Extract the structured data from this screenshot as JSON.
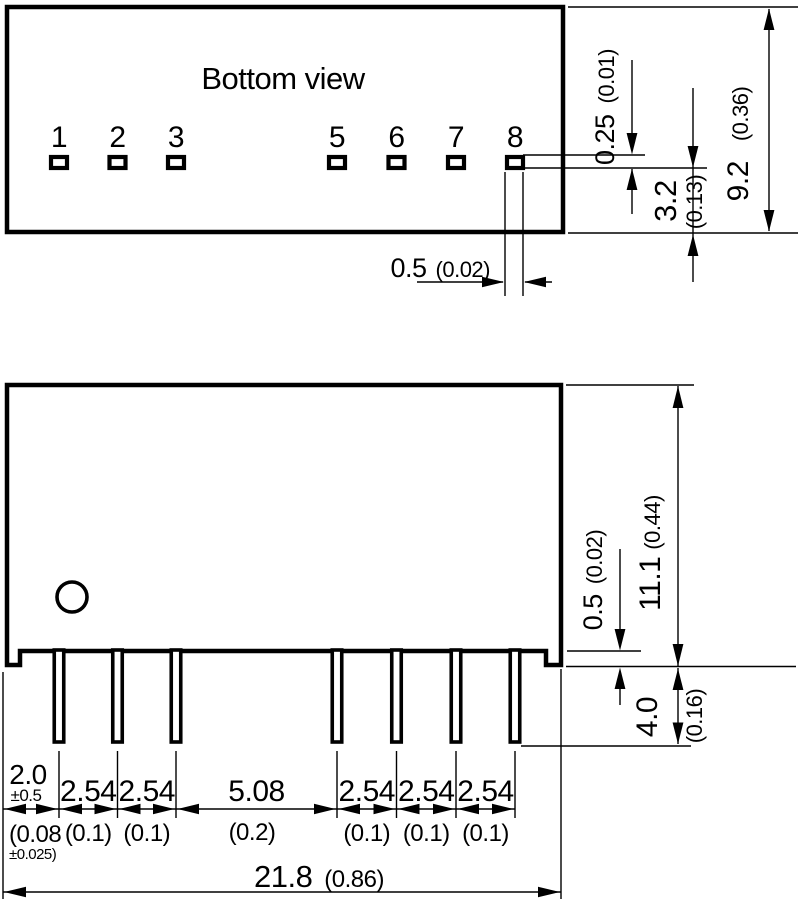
{
  "colors": {
    "ink": "#000000",
    "paper": "#ffffff"
  },
  "bottom_view": {
    "title": "Bottom view",
    "pin_labels": [
      "1",
      "2",
      "3",
      "5",
      "6",
      "7",
      "8"
    ],
    "dims": {
      "pin_thickness": {
        "mm": "0.25",
        "inch": "(0.01)"
      },
      "pin_to_edge": {
        "mm": "3.2",
        "inch": "(0.13)"
      },
      "body_depth": {
        "mm": "9.2",
        "inch": "(0.36)"
      },
      "pin_width": {
        "mm": "0.5",
        "inch": "(0.02)"
      }
    }
  },
  "side_view": {
    "dims": {
      "case_height": {
        "mm": "11.1",
        "inch": "(0.44)"
      },
      "standoff": {
        "mm": "0.5",
        "inch": "(0.02)"
      },
      "pin_length": {
        "mm": "4.0",
        "inch": "(0.16)"
      },
      "pin1_to_edge": {
        "mm": "2.0",
        "mm_tol": "±0.5",
        "inch": "(0.08",
        "inch_tol": "±0.025)"
      },
      "pitch": [
        {
          "mm": "2.54",
          "inch": "(0.1)"
        },
        {
          "mm": "2.54",
          "inch": "(0.1)"
        },
        {
          "mm": "5.08",
          "inch": "(0.2)"
        },
        {
          "mm": "2.54",
          "inch": "(0.1)"
        },
        {
          "mm": "2.54",
          "inch": "(0.1)"
        },
        {
          "mm": "2.54",
          "inch": "(0.1)"
        }
      ],
      "body_width": {
        "mm": "21.8",
        "inch": "(0.86)"
      }
    }
  }
}
